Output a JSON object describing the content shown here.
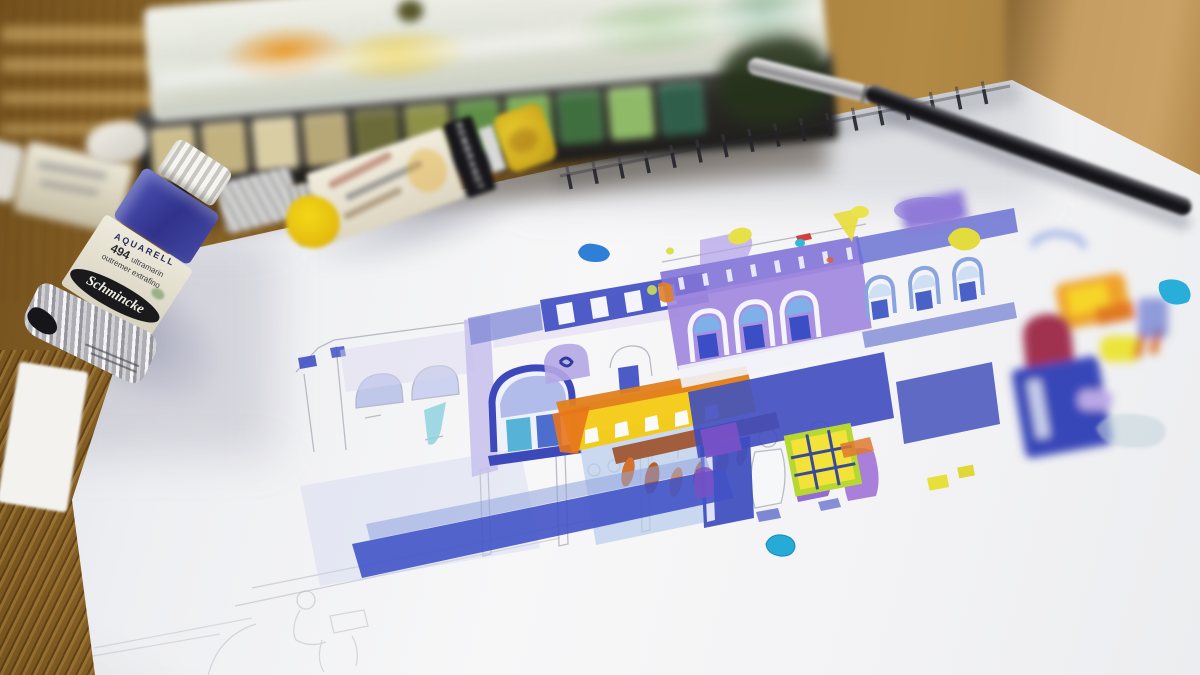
{
  "scene": {
    "description": "Close-up photo of a loose watercolor sketch of a row of heritage shophouses on a spiral-bound pad, with an open watercolor palette box, squeezed paint tubes and a brush on a wooden table",
    "depth_of_field": "shallow - sketch foreground sharp, palette box and table blurred"
  },
  "table": {
    "material": "wood grain",
    "tone_hex": "#a07a3a"
  },
  "sketchbook": {
    "type": "spiral-bound pad",
    "paper_color": "#f4f4f6",
    "binding_color": "#24242a"
  },
  "painting": {
    "subject": "row of shophouses with arched windows, yellow-orange awning, hanging roast ducks and sketched figures under the five-foot way",
    "media": "pencil and watercolor",
    "palette": {
      "cobalt": "#4353c2",
      "ultramarine": "#3b3f9e",
      "lavender": "#b7a9e6",
      "purple": "#8f6fd2",
      "sky_blue": "#9fc0ea",
      "teal": "#49b8d8",
      "yellow": "#f2cf1c",
      "orange": "#e2801e",
      "rust": "#b85c26",
      "chartreuse": "#bcd832",
      "maroon": "#a03050",
      "pencil_gray": "#a9adb8"
    }
  },
  "palette_box": {
    "lid": "translucent white lid stained orange, yellow and green",
    "pans": "earth and green half-pans in dark metal tray",
    "body_color": "#2c2b28"
  },
  "brush": {
    "handle_color": "#111115",
    "ferrule_color": "#c9c9cc"
  },
  "tubes": {
    "ultramarine": {
      "brand_label": "Schmincke",
      "series_label": "AQUARELL",
      "number_label": "494",
      "pigment_label": "ultramarin",
      "alt_language_label": "outremer extrafino",
      "cap_color": "#e9e9e4",
      "band_color": "#3c3f9d",
      "state": "crumpled silver foil end"
    },
    "yellow": {
      "side_label": "REMBRANDT",
      "cap_color": "#d8b83a",
      "paint_smear_color": "#eec81a"
    },
    "background_tube": {
      "cap_color": "#e8e6de"
    }
  }
}
